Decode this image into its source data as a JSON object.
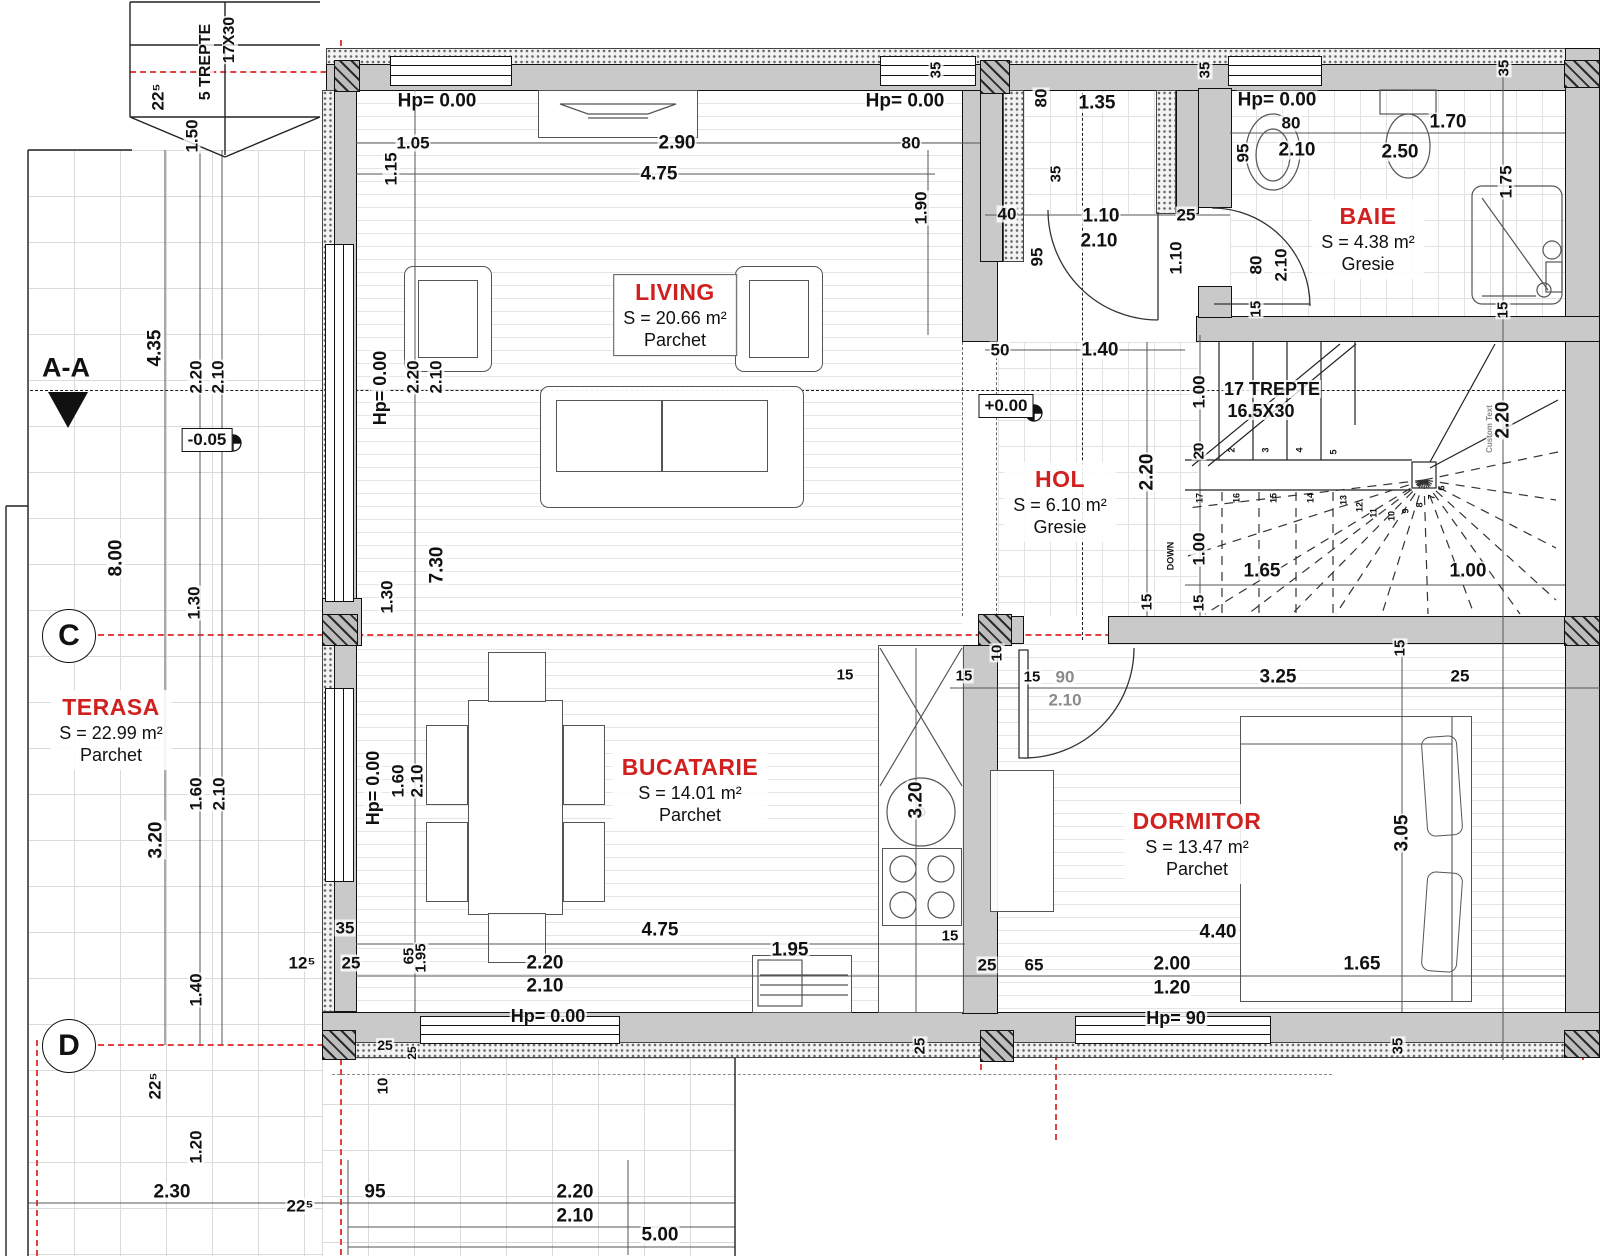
{
  "axes": {
    "section": "A-A",
    "c": "C",
    "d": "D"
  },
  "levels": {
    "main": "+0.00",
    "terrace": "-0.05"
  },
  "colors": {
    "room_label_red": "#d02020",
    "axis_red": "#e34040",
    "wall_fill": "#c9c9c9",
    "hatch": "#2a2a2a"
  },
  "rooms": [
    {
      "name": "LIVING",
      "area": "S = 20.66 m²",
      "floor": "Parchet",
      "x": 675,
      "y": 315,
      "boxed": true
    },
    {
      "name": "BUCATARIE",
      "area": "S = 14.01 m²",
      "floor": "Parchet",
      "x": 690,
      "y": 790,
      "boxed": false
    },
    {
      "name": "DORMITOR",
      "area": "S = 13.47 m²",
      "floor": "Parchet",
      "x": 1197,
      "y": 844,
      "boxed": false
    },
    {
      "name": "HOL",
      "area": "S = 6.10 m²",
      "floor": "Gresie",
      "x": 1060,
      "y": 502,
      "boxed": false
    },
    {
      "name": "BAIE",
      "area": "S = 4.38 m²",
      "floor": "Gresie",
      "x": 1368,
      "y": 239,
      "boxed": false
    },
    {
      "name": "TERASA",
      "area": "S = 22.99 m²",
      "floor": "Parchet",
      "x": 111,
      "y": 730,
      "boxed": false
    }
  ],
  "dim_labels": [
    {
      "t": "5 TREPTE",
      "x": 206,
      "y": 62,
      "r": -90,
      "s": 16,
      "c": "b"
    },
    {
      "t": "17X30",
      "x": 230,
      "y": 40,
      "r": -90,
      "s": 16,
      "c": "b"
    },
    {
      "t": "22⁵",
      "x": 158,
      "y": 97,
      "r": -90,
      "s": 17
    },
    {
      "t": "1.50",
      "x": 192,
      "y": 136,
      "r": -90,
      "s": 17
    },
    {
      "t": "Hp= 0.00",
      "x": 437,
      "y": 101,
      "s": 19
    },
    {
      "t": "1.15",
      "x": 391,
      "y": 169,
      "r": -90,
      "s": 17
    },
    {
      "t": "1.05",
      "x": 413,
      "y": 143,
      "s": 17
    },
    {
      "t": "2.90",
      "x": 677,
      "y": 143,
      "s": 19
    },
    {
      "t": "80",
      "x": 911,
      "y": 143,
      "s": 17
    },
    {
      "t": "4.75",
      "x": 659,
      "y": 174,
      "s": 19
    },
    {
      "t": "Hp= 0.00",
      "x": 905,
      "y": 101,
      "s": 19
    },
    {
      "t": "1.90",
      "x": 921,
      "y": 208,
      "r": -90,
      "s": 17
    },
    {
      "t": "35",
      "x": 936,
      "y": 70,
      "r": -90,
      "s": 15
    },
    {
      "t": "80",
      "x": 1041,
      "y": 98,
      "r": -90,
      "s": 17
    },
    {
      "t": "1.35",
      "x": 1097,
      "y": 103,
      "s": 19
    },
    {
      "t": "35",
      "x": 1056,
      "y": 174,
      "r": -90,
      "s": 15
    },
    {
      "t": "40",
      "x": 1007,
      "y": 214,
      "s": 17
    },
    {
      "t": "1.10",
      "x": 1101,
      "y": 216,
      "s": 19
    },
    {
      "t": "2.10",
      "x": 1099,
      "y": 241,
      "s": 19
    },
    {
      "t": "25",
      "x": 1186,
      "y": 215,
      "s": 17
    },
    {
      "t": "95",
      "x": 1037,
      "y": 257,
      "r": -90,
      "s": 17
    },
    {
      "t": "1.10",
      "x": 1176,
      "y": 258,
      "r": -90,
      "s": 17
    },
    {
      "t": "35",
      "x": 1205,
      "y": 70,
      "r": -90,
      "s": 15
    },
    {
      "t": "Hp= 0.00",
      "x": 1277,
      "y": 100,
      "s": 19
    },
    {
      "t": "80",
      "x": 1291,
      "y": 123,
      "s": 17
    },
    {
      "t": "2.10",
      "x": 1297,
      "y": 150,
      "s": 19
    },
    {
      "t": "95",
      "x": 1243,
      "y": 153,
      "r": -90,
      "s": 17
    },
    {
      "t": "1.70",
      "x": 1448,
      "y": 122,
      "s": 19
    },
    {
      "t": "2.50",
      "x": 1400,
      "y": 152,
      "s": 19
    },
    {
      "t": "35",
      "x": 1504,
      "y": 68,
      "r": -90,
      "s": 15
    },
    {
      "t": "1.75",
      "x": 1506,
      "y": 182,
      "r": -90,
      "s": 17
    },
    {
      "t": "80",
      "x": 1256,
      "y": 265,
      "r": -90,
      "s": 17
    },
    {
      "t": "2.10",
      "x": 1281,
      "y": 265,
      "r": -90,
      "s": 17
    },
    {
      "t": "15",
      "x": 1256,
      "y": 309,
      "r": -90,
      "s": 15
    },
    {
      "t": "50",
      "x": 1000,
      "y": 350,
      "s": 17
    },
    {
      "t": "1.40",
      "x": 1100,
      "y": 350,
      "s": 19
    },
    {
      "t": "1.00",
      "x": 1199,
      "y": 392,
      "r": -90,
      "s": 17
    },
    {
      "t": "20",
      "x": 1199,
      "y": 451,
      "r": -90,
      "s": 15
    },
    {
      "t": "2.20",
      "x": 1147,
      "y": 472,
      "r": -90,
      "s": 19
    },
    {
      "t": "15",
      "x": 1147,
      "y": 602,
      "r": -90,
      "s": 15
    },
    {
      "t": "1.00",
      "x": 1199,
      "y": 549,
      "r": -90,
      "s": 17
    },
    {
      "t": "15",
      "x": 1199,
      "y": 603,
      "r": -90,
      "s": 15
    },
    {
      "t": "1.65",
      "x": 1262,
      "y": 571,
      "s": 19
    },
    {
      "t": "1.00",
      "x": 1468,
      "y": 571,
      "s": 19
    },
    {
      "t": "2.20",
      "x": 1503,
      "y": 420,
      "r": -90,
      "s": 19
    },
    {
      "t": "15",
      "x": 1503,
      "y": 310,
      "r": -90,
      "s": 15
    },
    {
      "t": "DOWN",
      "x": 1171,
      "y": 556,
      "r": -90,
      "s": 9
    },
    {
      "t": "Custom Text",
      "x": 1490,
      "y": 429,
      "r": -90,
      "s": 8,
      "c": "gray"
    },
    {
      "t": "17 TREPTE",
      "x": 1272,
      "y": 389,
      "s": 18,
      "c": "b"
    },
    {
      "t": "16.5X30",
      "x": 1261,
      "y": 411,
      "s": 18,
      "c": "b"
    },
    {
      "t": "4.35",
      "x": 155,
      "y": 348,
      "r": -90,
      "s": 19
    },
    {
      "t": "2.20",
      "x": 196,
      "y": 377,
      "r": -90,
      "s": 17
    },
    {
      "t": "2.10",
      "x": 218,
      "y": 377,
      "r": -90,
      "s": 17
    },
    {
      "t": "8.00",
      "x": 116,
      "y": 558,
      "r": -90,
      "s": 19
    },
    {
      "t": "1.30",
      "x": 194,
      "y": 603,
      "r": -90,
      "s": 17
    },
    {
      "t": "1.30",
      "x": 387,
      "y": 597,
      "r": -90,
      "s": 17
    },
    {
      "t": "7.30",
      "x": 437,
      "y": 565,
      "r": -90,
      "s": 19
    },
    {
      "t": "2.20",
      "x": 413,
      "y": 377,
      "r": -90,
      "s": 17
    },
    {
      "t": "2.10",
      "x": 436,
      "y": 377,
      "r": -90,
      "s": 17
    },
    {
      "t": "Hp= 0.00",
      "x": 380,
      "y": 388,
      "r": -90,
      "s": 18
    },
    {
      "t": "1.60",
      "x": 196,
      "y": 794,
      "r": -90,
      "s": 17
    },
    {
      "t": "2.10",
      "x": 219,
      "y": 794,
      "r": -90,
      "s": 17
    },
    {
      "t": "3.20",
      "x": 156,
      "y": 840,
      "r": -90,
      "s": 19
    },
    {
      "t": "1.60",
      "x": 398,
      "y": 781,
      "r": -90,
      "s": 17
    },
    {
      "t": "2.10",
      "x": 417,
      "y": 781,
      "r": -90,
      "s": 17
    },
    {
      "t": "Hp= 0.00",
      "x": 373,
      "y": 788,
      "r": -90,
      "s": 18
    },
    {
      "t": "1.40",
      "x": 196,
      "y": 990,
      "r": -90,
      "s": 17
    },
    {
      "t": "22⁵",
      "x": 155,
      "y": 1086,
      "r": -90,
      "s": 17
    },
    {
      "t": "1.20",
      "x": 196,
      "y": 1147,
      "r": -90,
      "s": 17
    },
    {
      "t": "35",
      "x": 345,
      "y": 928,
      "s": 17
    },
    {
      "t": "25",
      "x": 351,
      "y": 963,
      "s": 17
    },
    {
      "t": "12⁵",
      "x": 302,
      "y": 963,
      "s": 17
    },
    {
      "t": "65",
      "x": 409,
      "y": 956,
      "r": -90,
      "s": 15
    },
    {
      "t": "1.95",
      "x": 421,
      "y": 958,
      "r": -90,
      "s": 15
    },
    {
      "t": "15",
      "x": 845,
      "y": 675,
      "s": 15
    },
    {
      "t": "3.20",
      "x": 916,
      "y": 800,
      "r": -90,
      "s": 19
    },
    {
      "t": "4.75",
      "x": 660,
      "y": 930,
      "s": 19
    },
    {
      "t": "1.95",
      "x": 790,
      "y": 950,
      "s": 19
    },
    {
      "t": "15",
      "x": 950,
      "y": 936,
      "s": 15
    },
    {
      "t": "2.20",
      "x": 545,
      "y": 963,
      "s": 19
    },
    {
      "t": "2.10",
      "x": 545,
      "y": 986,
      "s": 19
    },
    {
      "t": "Hp= 0.00",
      "x": 548,
      "y": 1016,
      "s": 18
    },
    {
      "t": "25",
      "x": 920,
      "y": 1046,
      "r": -90,
      "s": 15
    },
    {
      "t": "10",
      "x": 383,
      "y": 1086,
      "r": -90,
      "s": 15
    },
    {
      "t": "25",
      "x": 385,
      "y": 1045,
      "s": 14
    },
    {
      "t": "25",
      "x": 412,
      "y": 1053,
      "r": -90,
      "s": 12
    },
    {
      "t": "95",
      "x": 375,
      "y": 1192,
      "s": 19
    },
    {
      "t": "2.30",
      "x": 172,
      "y": 1192,
      "s": 19
    },
    {
      "t": "2.20",
      "x": 575,
      "y": 1192,
      "s": 19
    },
    {
      "t": "2.10",
      "x": 575,
      "y": 1216,
      "s": 19
    },
    {
      "t": "5.00",
      "x": 660,
      "y": 1235,
      "s": 19
    },
    {
      "t": "22⁵",
      "x": 300,
      "y": 1206,
      "s": 17
    },
    {
      "t": "10",
      "x": 997,
      "y": 653,
      "r": -90,
      "s": 15
    },
    {
      "t": "15",
      "x": 964,
      "y": 676,
      "s": 15
    },
    {
      "t": "15",
      "x": 1032,
      "y": 677,
      "s": 15
    },
    {
      "t": "90",
      "x": 1065,
      "y": 677,
      "s": 17,
      "c": "gray"
    },
    {
      "t": "2.10",
      "x": 1065,
      "y": 700,
      "s": 17,
      "c": "gray"
    },
    {
      "t": "3.25",
      "x": 1278,
      "y": 677,
      "s": 19
    },
    {
      "t": "25",
      "x": 1460,
      "y": 676,
      "s": 17
    },
    {
      "t": "15",
      "x": 1400,
      "y": 648,
      "r": -90,
      "s": 15
    },
    {
      "t": "3.05",
      "x": 1402,
      "y": 833,
      "r": -90,
      "s": 19
    },
    {
      "t": "4.40",
      "x": 1218,
      "y": 932,
      "s": 19
    },
    {
      "t": "25",
      "x": 987,
      "y": 965,
      "s": 17
    },
    {
      "t": "65",
      "x": 1034,
      "y": 965,
      "s": 17
    },
    {
      "t": "2.00",
      "x": 1172,
      "y": 964,
      "s": 19
    },
    {
      "t": "1.20",
      "x": 1172,
      "y": 988,
      "s": 19
    },
    {
      "t": "1.65",
      "x": 1362,
      "y": 964,
      "s": 19
    },
    {
      "t": "Hp= 90",
      "x": 1176,
      "y": 1018,
      "s": 18
    },
    {
      "t": "35",
      "x": 1398,
      "y": 1046,
      "r": -90,
      "s": 15
    }
  ],
  "stair_numbers": [
    {
      "t": "1",
      "x": 1198,
      "y": 450
    },
    {
      "t": "2",
      "x": 1232,
      "y": 450
    },
    {
      "t": "3",
      "x": 1266,
      "y": 450
    },
    {
      "t": "4",
      "x": 1300,
      "y": 450
    },
    {
      "t": "5",
      "x": 1334,
      "y": 452
    },
    {
      "t": "17",
      "x": 1200,
      "y": 498
    },
    {
      "t": "16",
      "x": 1237,
      "y": 498
    },
    {
      "t": "15",
      "x": 1274,
      "y": 498
    },
    {
      "t": "14",
      "x": 1311,
      "y": 498
    },
    {
      "t": "13",
      "x": 1344,
      "y": 500
    },
    {
      "t": "12",
      "x": 1360,
      "y": 507
    },
    {
      "t": "11",
      "x": 1374,
      "y": 513
    },
    {
      "t": "10",
      "x": 1392,
      "y": 516
    },
    {
      "t": "9",
      "x": 1406,
      "y": 511
    },
    {
      "t": "8",
      "x": 1420,
      "y": 505
    },
    {
      "t": "7",
      "x": 1432,
      "y": 497
    },
    {
      "t": "6",
      "x": 1442,
      "y": 488
    }
  ]
}
